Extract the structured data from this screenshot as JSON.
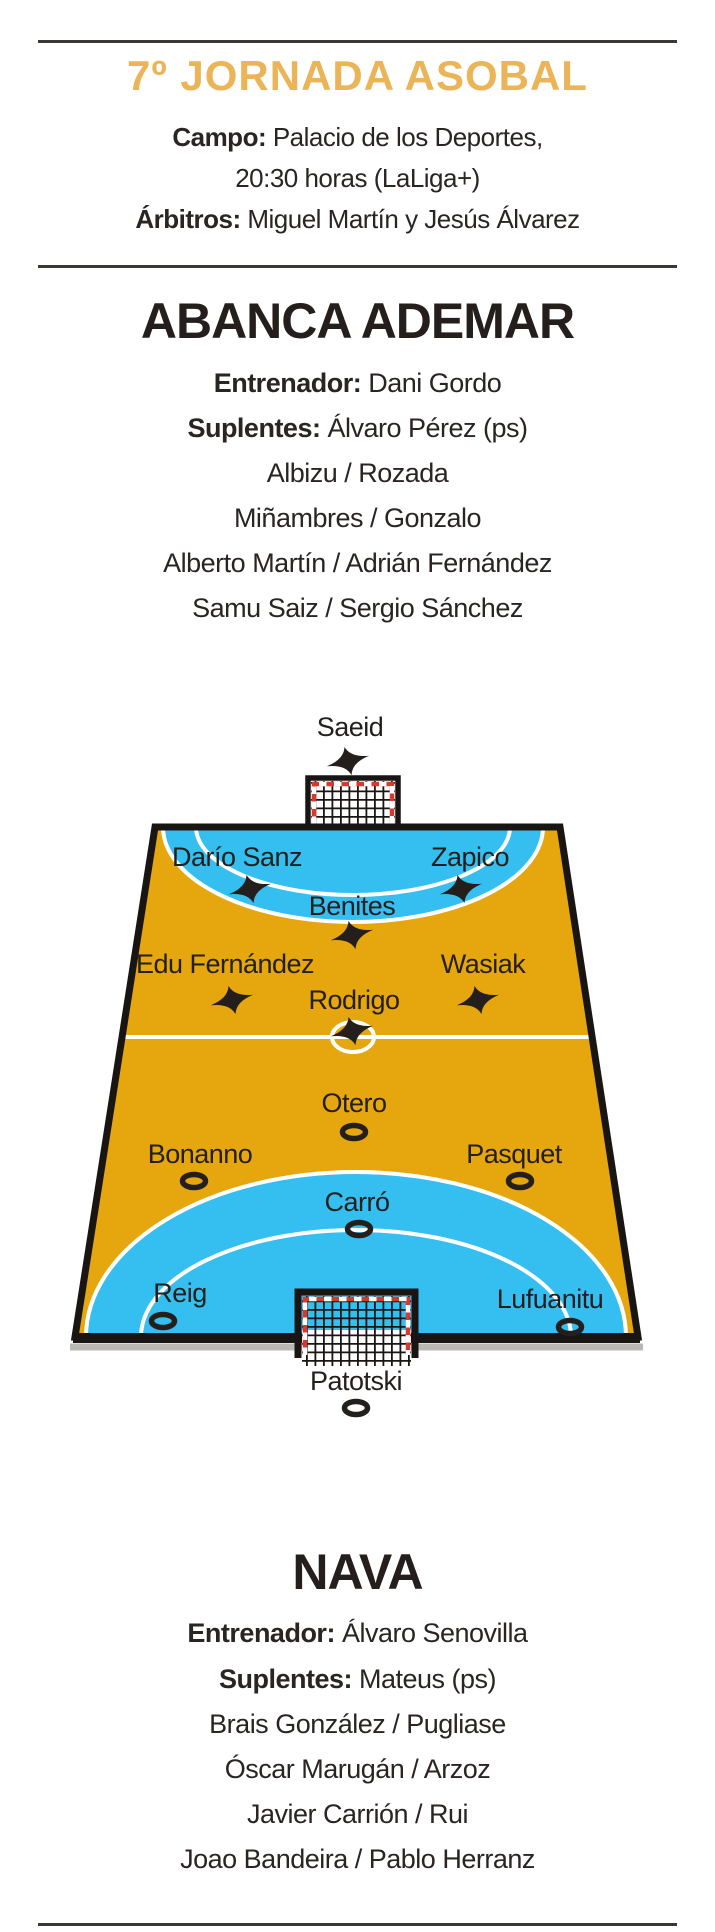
{
  "header": {
    "title": "7º JORNADA ASOBAL",
    "campo_label": "Campo:",
    "campo_value": "Palacio de los Deportes,",
    "time_line": "20:30 horas (LaLiga+)",
    "arbitros_label": "Árbitros:",
    "arbitros_value": "Miguel Martín y Jesús Álvarez"
  },
  "home_team": {
    "name": "ABANCA ADEMAR",
    "entrenador_label": "Entrenador:",
    "entrenador": "Dani Gordo",
    "suplentes_label": "Suplentes:",
    "suplentes": [
      "Álvaro Pérez (ps)",
      "Albizu / Rozada",
      "Miñambres / Gonzalo",
      "Alberto Martín / Adrián Fernández",
      "Samu Saiz / Sergio Sánchez"
    ],
    "marker": "x-star"
  },
  "away_team": {
    "name": "NAVA",
    "entrenador_label": "Entrenador:",
    "entrenador": "Álvaro Senovilla",
    "suplentes_label": "Suplentes:",
    "suplentes": [
      "Mateus (ps)",
      "Brais González / Pugliase",
      "Óscar Marugán / Arzoz",
      "Javier Carrión / Rui",
      "Joao Bandeira / Pablo Herranz"
    ],
    "marker": "o-ring"
  },
  "court": {
    "home_players": [
      {
        "name": "Saeid"
      },
      {
        "name": "Darío Sanz"
      },
      {
        "name": "Zapico"
      },
      {
        "name": "Benites"
      },
      {
        "name": "Edu Fernández"
      },
      {
        "name": "Wasiak"
      },
      {
        "name": "Rodrigo"
      }
    ],
    "away_players": [
      {
        "name": "Otero"
      },
      {
        "name": "Bonanno"
      },
      {
        "name": "Pasquet"
      },
      {
        "name": "Carró"
      },
      {
        "name": "Reig"
      },
      {
        "name": "Lufuanitu"
      },
      {
        "name": "Patotski"
      }
    ],
    "colors": {
      "gold": "#ebb457",
      "court_orange": "#e5a60e",
      "goal_area_cyan": "#35bff0",
      "line_white": "#ffffff",
      "border_black": "#191513",
      "goal_red": "#d8382e"
    }
  }
}
